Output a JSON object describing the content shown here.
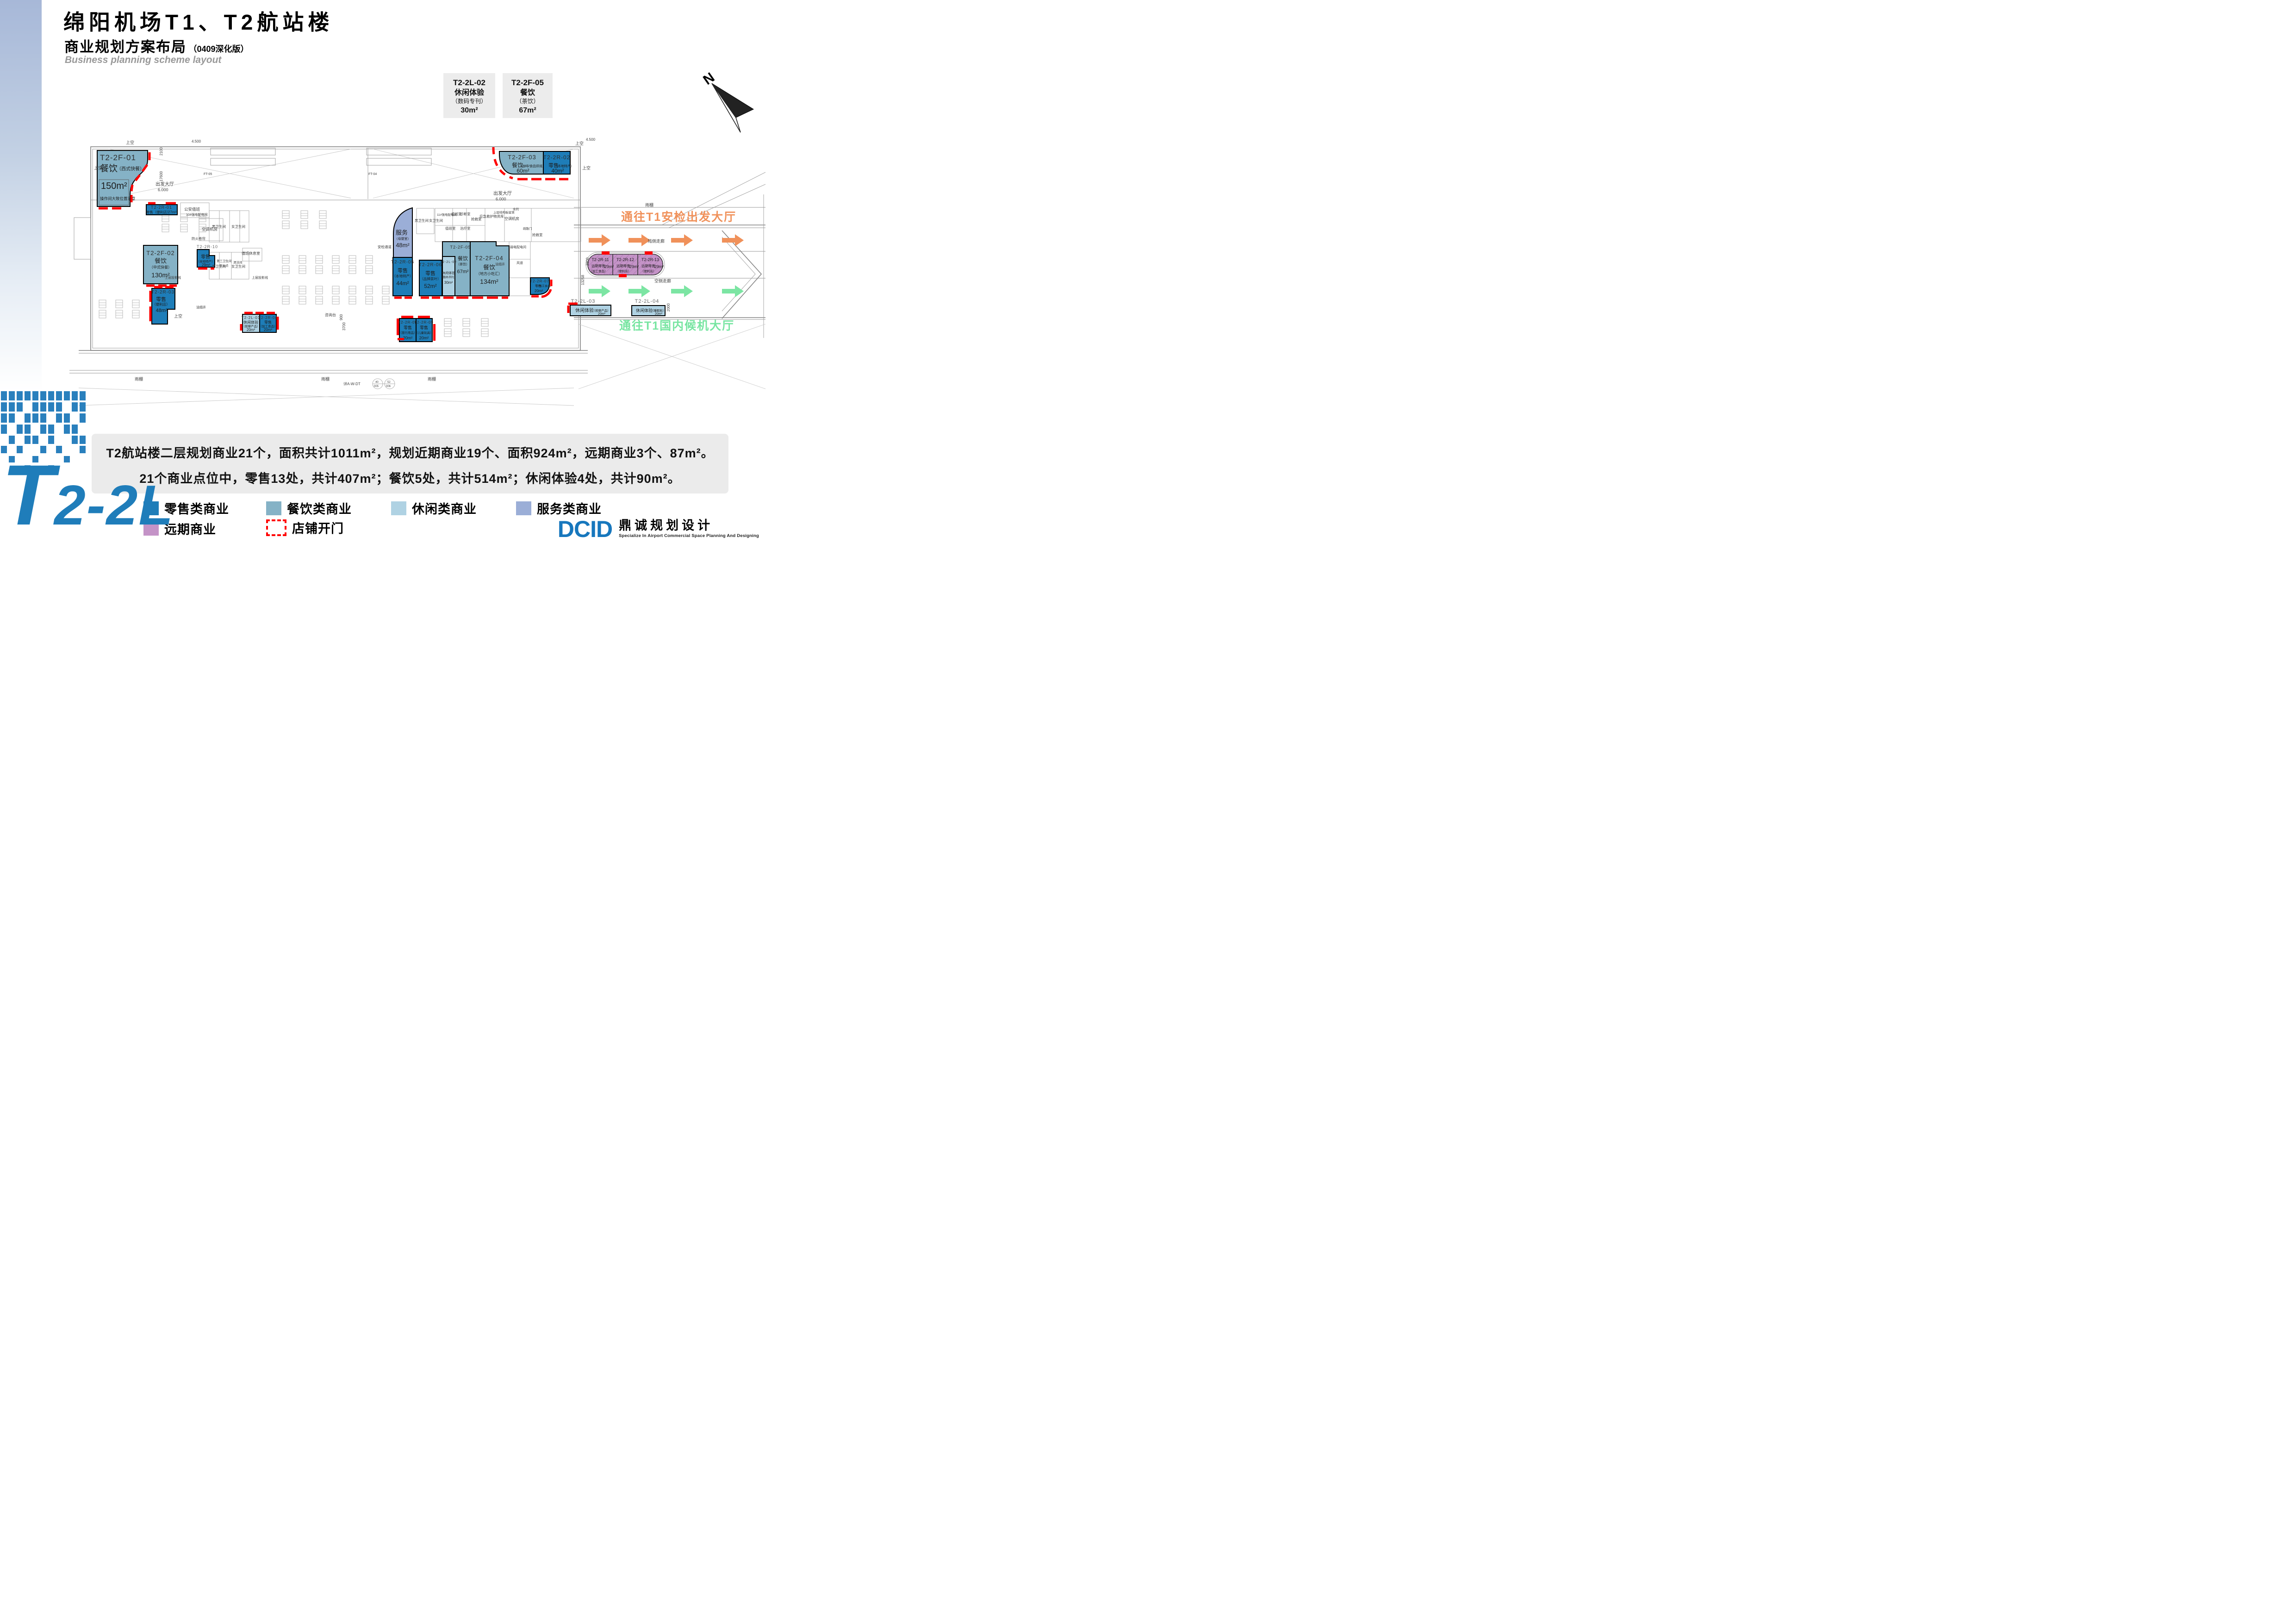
{
  "header": {
    "title": "绵阳机场T1、T2航站楼",
    "subtitle": "商业规划方案布局",
    "subtitle_note": "（0409深化版）",
    "subtitle_en": "Business planning scheme layout"
  },
  "callouts": [
    {
      "id": "T2-2L-02",
      "name": "休闲体验",
      "sub": "（数码专刊）",
      "area": "30m²"
    },
    {
      "id": "T2-2F-05",
      "name": "餐饮",
      "sub": "（茶饮）",
      "area": "67m²"
    }
  ],
  "compass_label": "N",
  "plan": {
    "routes": {
      "to_security": "通往T1安检出发大厅",
      "to_waiting": "通往T1国内候机大厅"
    },
    "blocks": [
      {
        "id": "T2-2F-01",
        "name": "餐饮",
        "sub": "（西式快餐）",
        "area": "150m²",
        "note": "操作间大致位置示意"
      },
      {
        "id": "T2-2R-01",
        "name": "零售（便利店）",
        "area": "27m²"
      },
      {
        "id": "T2-2F-02",
        "name": "餐饮",
        "sub": "（中式快餐）",
        "area": "130m²"
      },
      {
        "id": "T2-2R-10",
        "name": "零售",
        "sub": "（本地特产）",
        "area": "29m²"
      },
      {
        "id": "T2-2R-03",
        "name": "零售",
        "sub": "（便利店）",
        "area": "48m²"
      },
      {
        "id": "T2-2L-01",
        "name": "休闲体验",
        "sub": "（按摩产品）",
        "area": "20m²"
      },
      {
        "id": "T2-2R-04",
        "name": "零售",
        "sub": "（加工食品）",
        "area": "20m²"
      },
      {
        "id": "",
        "name": "服务",
        "sub": "（母婴室）",
        "area": "48m²"
      },
      {
        "id": "T2-2R-05",
        "name": "零售",
        "sub": "（本地特产）",
        "area": "44m²"
      },
      {
        "id": "T2-2R-06",
        "name": "零售",
        "sub": "（品牌茶叶）",
        "area": "52m²"
      },
      {
        "id": "T2-2L-02",
        "name": "休闲体验",
        "sub": "（数码书刊）",
        "area": "30m²"
      },
      {
        "id": "T2-2F-05",
        "name": "餐饮",
        "sub": "（茶饮）",
        "area": "67m²"
      },
      {
        "id": "T2-2F-04",
        "name": "餐饮",
        "sub": "（地方小吃汇）",
        "area": "134m²"
      },
      {
        "id": "T2-2R-07",
        "name": "零售",
        "sub": "（加工食品）",
        "area": "20m²"
      },
      {
        "id": "T2-2R-08",
        "name": "零售",
        "sub": "（旅行用品）",
        "area": "20m²"
      },
      {
        "id": "T2-2R-09",
        "name": "零售",
        "sub": "（儿童玩具）",
        "area": "20m²"
      },
      {
        "id": "T2-2F-03",
        "name": "餐饮",
        "sub": "（咖啡/食品烘焙）",
        "area": "60m²"
      },
      {
        "id": "T2-2R-02",
        "name": "零售",
        "sub": "（本地特产）",
        "area": "40m²"
      },
      {
        "id": "T2-2L-03",
        "name": "休闲体验",
        "sub": "（按摩产品）",
        "area": "20m²"
      },
      {
        "id": "T2-2L-04",
        "name": "休闲体验",
        "sub": "（睡眠舱）",
        "area": "20m²"
      },
      {
        "id": "T2-2R-11",
        "name": "远期零售",
        "sub": "（加工食品）",
        "area": "29m²"
      },
      {
        "id": "T2-2R-12",
        "name": "远期零售",
        "sub": "（便利店）",
        "area": "29m²"
      },
      {
        "id": "T2-2R-13",
        "name": "远期零售",
        "sub": "（便利店）",
        "area": "29m²"
      }
    ],
    "rooms": [
      "上空",
      "上空",
      "上空",
      "上空",
      "上空",
      "出发大厅",
      "6.000",
      "出发大厅",
      "6.000",
      "公安值班",
      "10#强电配电间",
      "空调机房",
      "男卫生间",
      "女卫生间",
      "男卫生间",
      "女卫生间",
      "值班休息室",
      "第三卫生间",
      "清洁间",
      "饮水点",
      "防火卷帘",
      "上层投影线",
      "上层投影线",
      "油烟井",
      "安检通道",
      "男卫生间",
      "女卫生间",
      "11#强电配电间",
      "值班室",
      "诊断室",
      "抢救室",
      "治疗室",
      "应急救护物资库",
      "空调机房",
      "抢救室",
      "弱电配电间",
      "风道",
      "油烟井",
      "咨询台",
      "雨棚",
      "雨棚",
      "雨棚",
      "雨棚",
      "陆侧走廊",
      "空侧走廊",
      "上层结构板留洞",
      "疏散门",
      "值班室",
      "余同",
      "FT-05",
      "FT-04"
    ],
    "dims": [
      "4.500",
      "4.500",
      "17600",
      "2100",
      "3700",
      "900",
      "13258",
      "3800",
      "2000"
    ],
    "annotations": [
      "详A-W-DT",
      "40",
      "005",
      "52",
      "006"
    ]
  },
  "summary": {
    "line1": "T2航站楼二层规划商业21个，面积共计1011m²，规划近期商业19个、面积924m²，远期商业3个、87m²。",
    "line2": "21个商业点位中，零售13处，共计407m²；餐饮5处，共计514m²；休闲体验4处，共计90m²。"
  },
  "legend": {
    "items": [
      {
        "label": "零售类商业",
        "color": "#1E7DB8"
      },
      {
        "label": "餐饮类商业",
        "color": "#85B2C6"
      },
      {
        "label": "休闲类商业",
        "color": "#AFD2E3"
      },
      {
        "label": "服务类商业",
        "color": "#9BAED7"
      }
    ],
    "future": {
      "label": "远期商业",
      "color": "#C493C7"
    },
    "door": {
      "label": "店铺开门",
      "color": "#FF0000"
    }
  },
  "footer": {
    "floor_code_t": "T",
    "floor_code_rest": "2-2L",
    "logo": "DCID",
    "logo_cn": "鼎诚规划设计",
    "logo_en": "Specialize In Airport Commercial Space Planning And Designing"
  },
  "colors": {
    "retail": "#1E7DB8",
    "dining": "#85B2C6",
    "leisure": "#AFD2E3",
    "service": "#9BAED7",
    "future": "#C493C7",
    "door_red": "#FF0000",
    "route_orange": "#F0915A",
    "route_green": "#7CE5A3",
    "brand_blue": "#1F7DBA"
  }
}
